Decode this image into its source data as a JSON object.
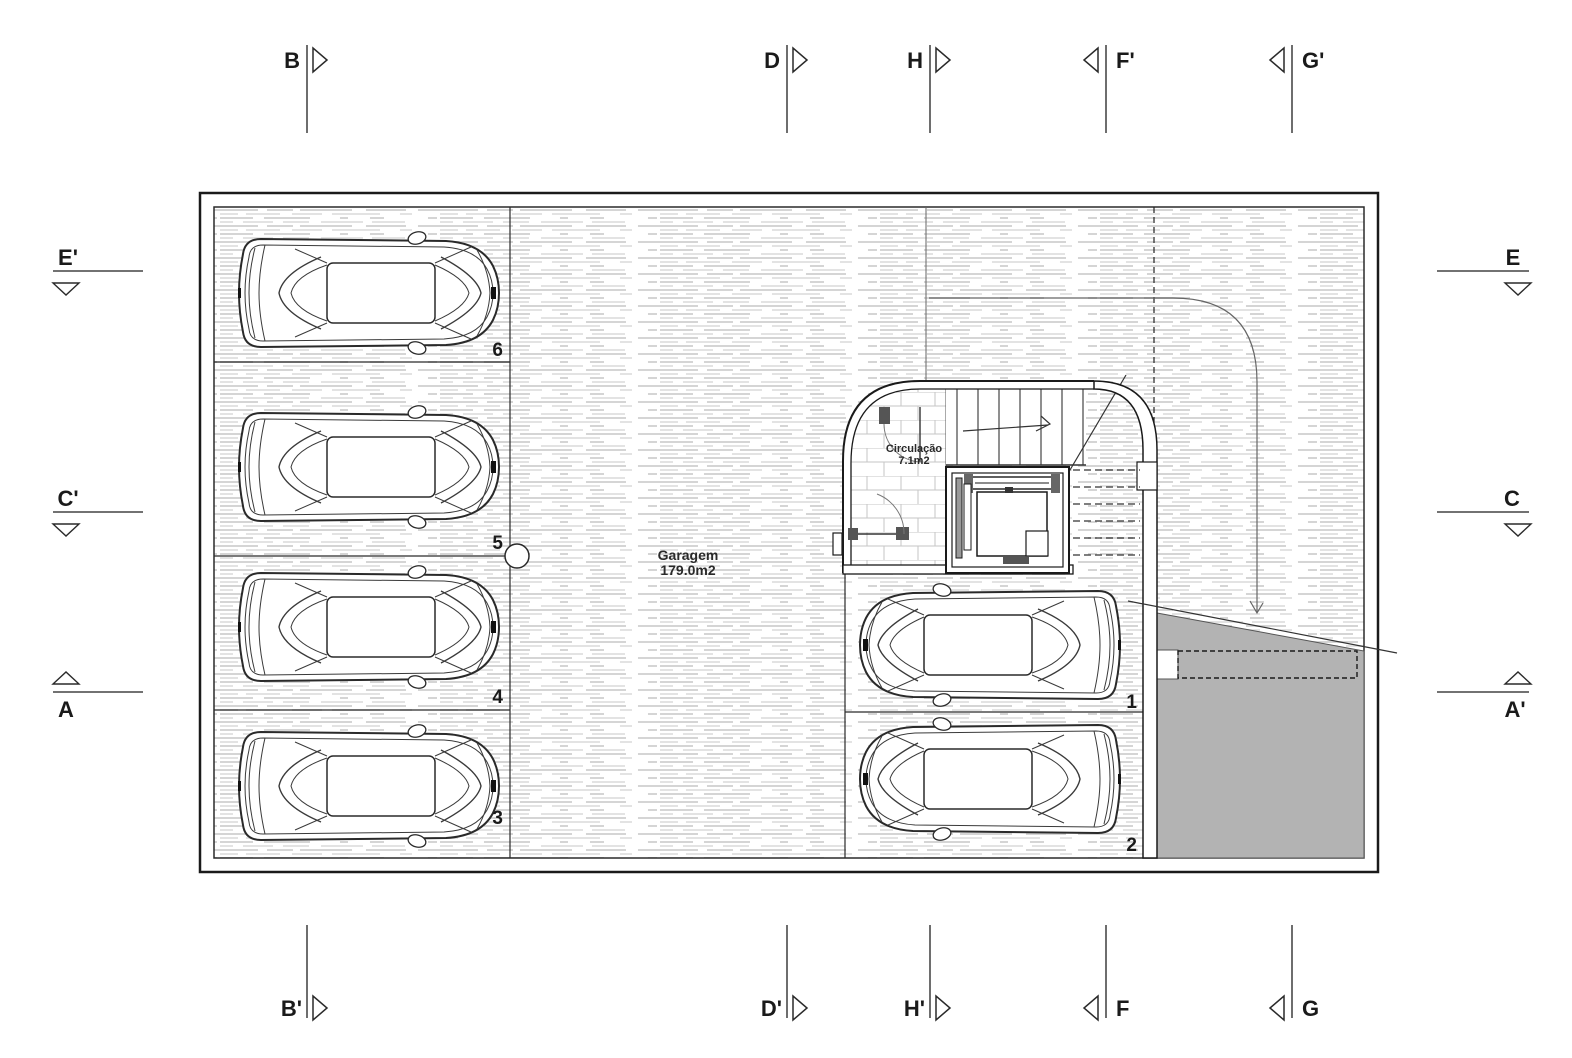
{
  "colors": {
    "line": "#1a1a1a",
    "hatch_light": "#d9d9d9",
    "ramp_fill": "#b3b3b3",
    "marker_line": "#6e6e6e"
  },
  "rooms": {
    "garage": {
      "label": "Garagem",
      "area": "179.0m2"
    },
    "circulation": {
      "label": "Circulação",
      "area": "7.1m2"
    }
  },
  "parking_spaces": [
    {
      "num": "6"
    },
    {
      "num": "5"
    },
    {
      "num": "4"
    },
    {
      "num": "3"
    },
    {
      "num": "1"
    },
    {
      "num": "2"
    }
  ],
  "section_markers": {
    "top": [
      {
        "label": "B"
      },
      {
        "label": "D"
      },
      {
        "label": "H"
      },
      {
        "label": "F'"
      },
      {
        "label": "G'"
      }
    ],
    "bottom": [
      {
        "label": "B'"
      },
      {
        "label": "D'"
      },
      {
        "label": "H'"
      },
      {
        "label": "F"
      },
      {
        "label": "G"
      }
    ],
    "left": [
      {
        "label": "E'"
      },
      {
        "label": "C'"
      },
      {
        "label": "A"
      }
    ],
    "right": [
      {
        "label": "E"
      },
      {
        "label": "C"
      },
      {
        "label": "A'"
      }
    ]
  }
}
